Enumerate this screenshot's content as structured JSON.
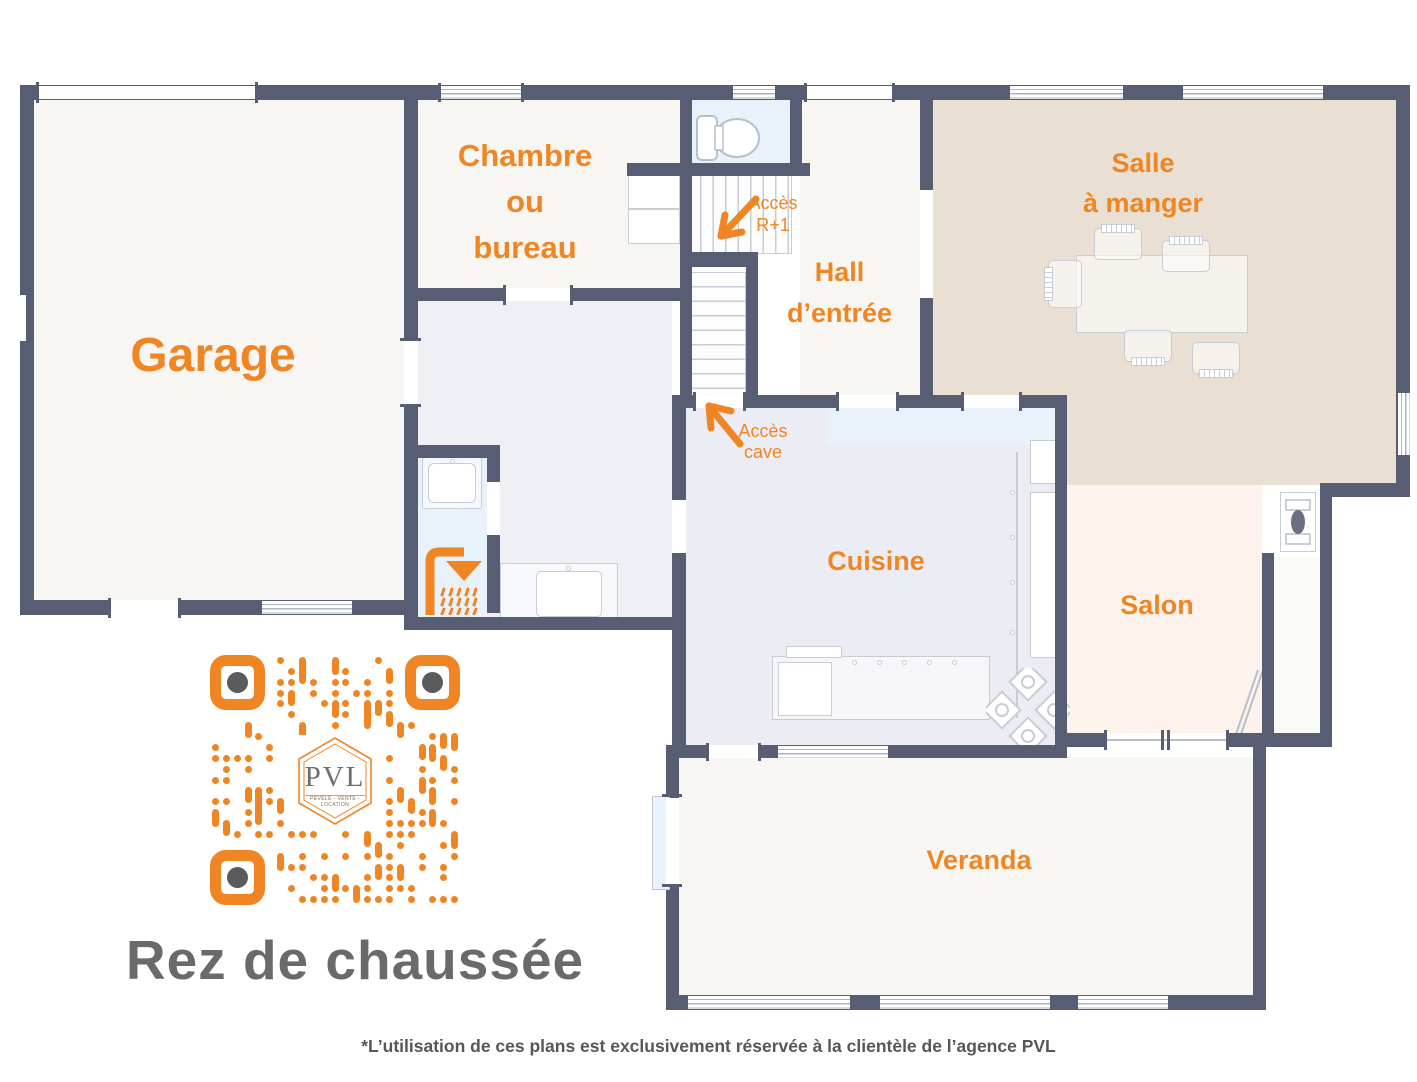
{
  "title": "Rez de chaussée",
  "footer": "*L’utilisation de ces plans est exclusivement réservée à la clientèle de l’agence PVL",
  "rooms": {
    "garage": {
      "label": "Garage"
    },
    "bedroom_office": {
      "line1": "Chambre",
      "line2": "ou",
      "line3": "bureau"
    },
    "hall": {
      "line1": "Hall",
      "line2": "d’entrée"
    },
    "dining": {
      "line1": "Salle",
      "line2": "à manger"
    },
    "kitchen": {
      "label": "Cuisine"
    },
    "living": {
      "label": "Salon"
    },
    "veranda": {
      "label": "Veranda"
    }
  },
  "annotations": {
    "access_upper": {
      "line1": "Accès",
      "line2": "R+1"
    },
    "access_cellar": {
      "line1": "Accès",
      "line2": "cave"
    }
  },
  "qr": {
    "logo": "PVL",
    "tagline": "PÉVÈLE - VENTE - LOCATION"
  },
  "colors": {
    "accent": "#EF8523",
    "wall": "#575E73",
    "title": "#6A6A6A",
    "footer": "#54585A",
    "furniture": "#C7CCD5",
    "fill_offwhite": "#F7F6F3",
    "fill_beige": "#E9DFD2",
    "fill_lavender": "#ECECF4",
    "fill_lavender_light": "#EEF0F6",
    "fill_blue": "#E9F1FA",
    "fill_peach": "#FDF3EC",
    "qr_dot": "#F08524",
    "qr_eye": "#5B5B5B"
  }
}
